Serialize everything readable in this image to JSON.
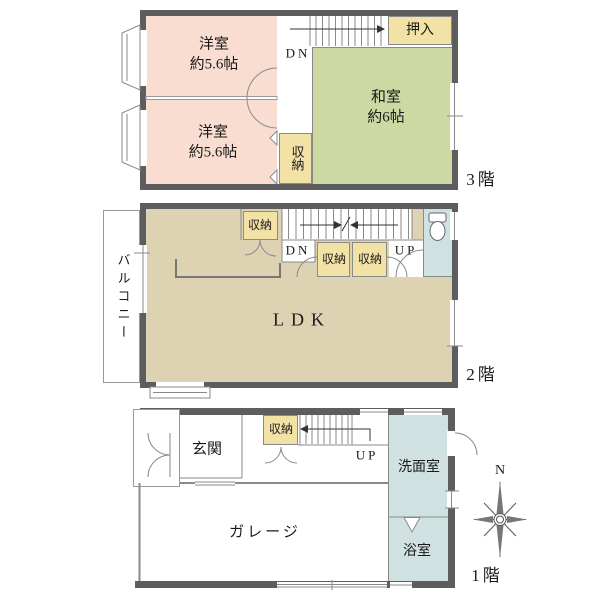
{
  "floor3": {
    "label": "3階",
    "western_room_1": {
      "name": "洋室",
      "size": "約5.6帖"
    },
    "western_room_2": {
      "name": "洋室",
      "size": "約5.6帖"
    },
    "japanese_room": {
      "name": "和室",
      "size": "約6帖"
    },
    "oshiire": "押入",
    "storage": "収納",
    "down": "DN"
  },
  "floor2": {
    "label": "2階",
    "balcony": "バルコニー",
    "ldk": "LDK",
    "storage_1": "収納",
    "storage_2": "収納",
    "storage_3": "収納",
    "down": "DN",
    "up": "UP"
  },
  "floor1": {
    "label": "1階",
    "entrance": "玄関",
    "storage": "収納",
    "up": "UP",
    "garage": "ガレージ",
    "washroom": "洗面室",
    "bathroom": "浴室",
    "compass_north": "N"
  },
  "colors": {
    "wall": "#5d5d5f",
    "western_room": "#f8ddd0",
    "japanese_room": "#ccd9a3",
    "storage": "#f2e2a6",
    "ldk": "#ddd2b2",
    "wet_area": "#cfe1e0",
    "line": "#777777"
  }
}
